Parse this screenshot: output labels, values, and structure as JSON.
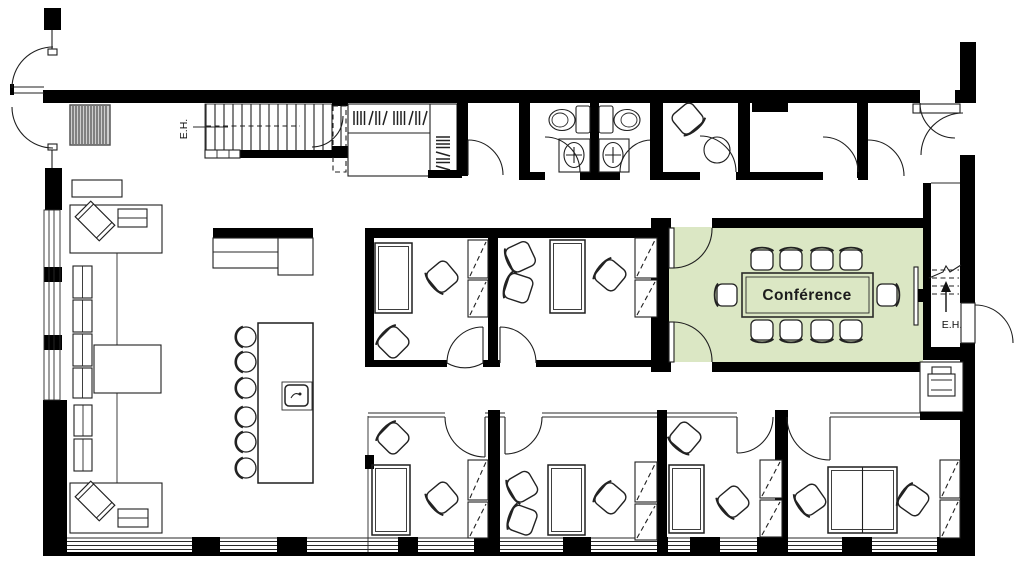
{
  "plan": {
    "labels": {
      "conference_room": "Conférence",
      "stair_left": "E.H.",
      "stair_right": "E.H."
    },
    "colors": {
      "highlight": "#dbe7c4",
      "wall": "#000000",
      "line": "#1f1f1f",
      "background": "#ffffff"
    }
  }
}
